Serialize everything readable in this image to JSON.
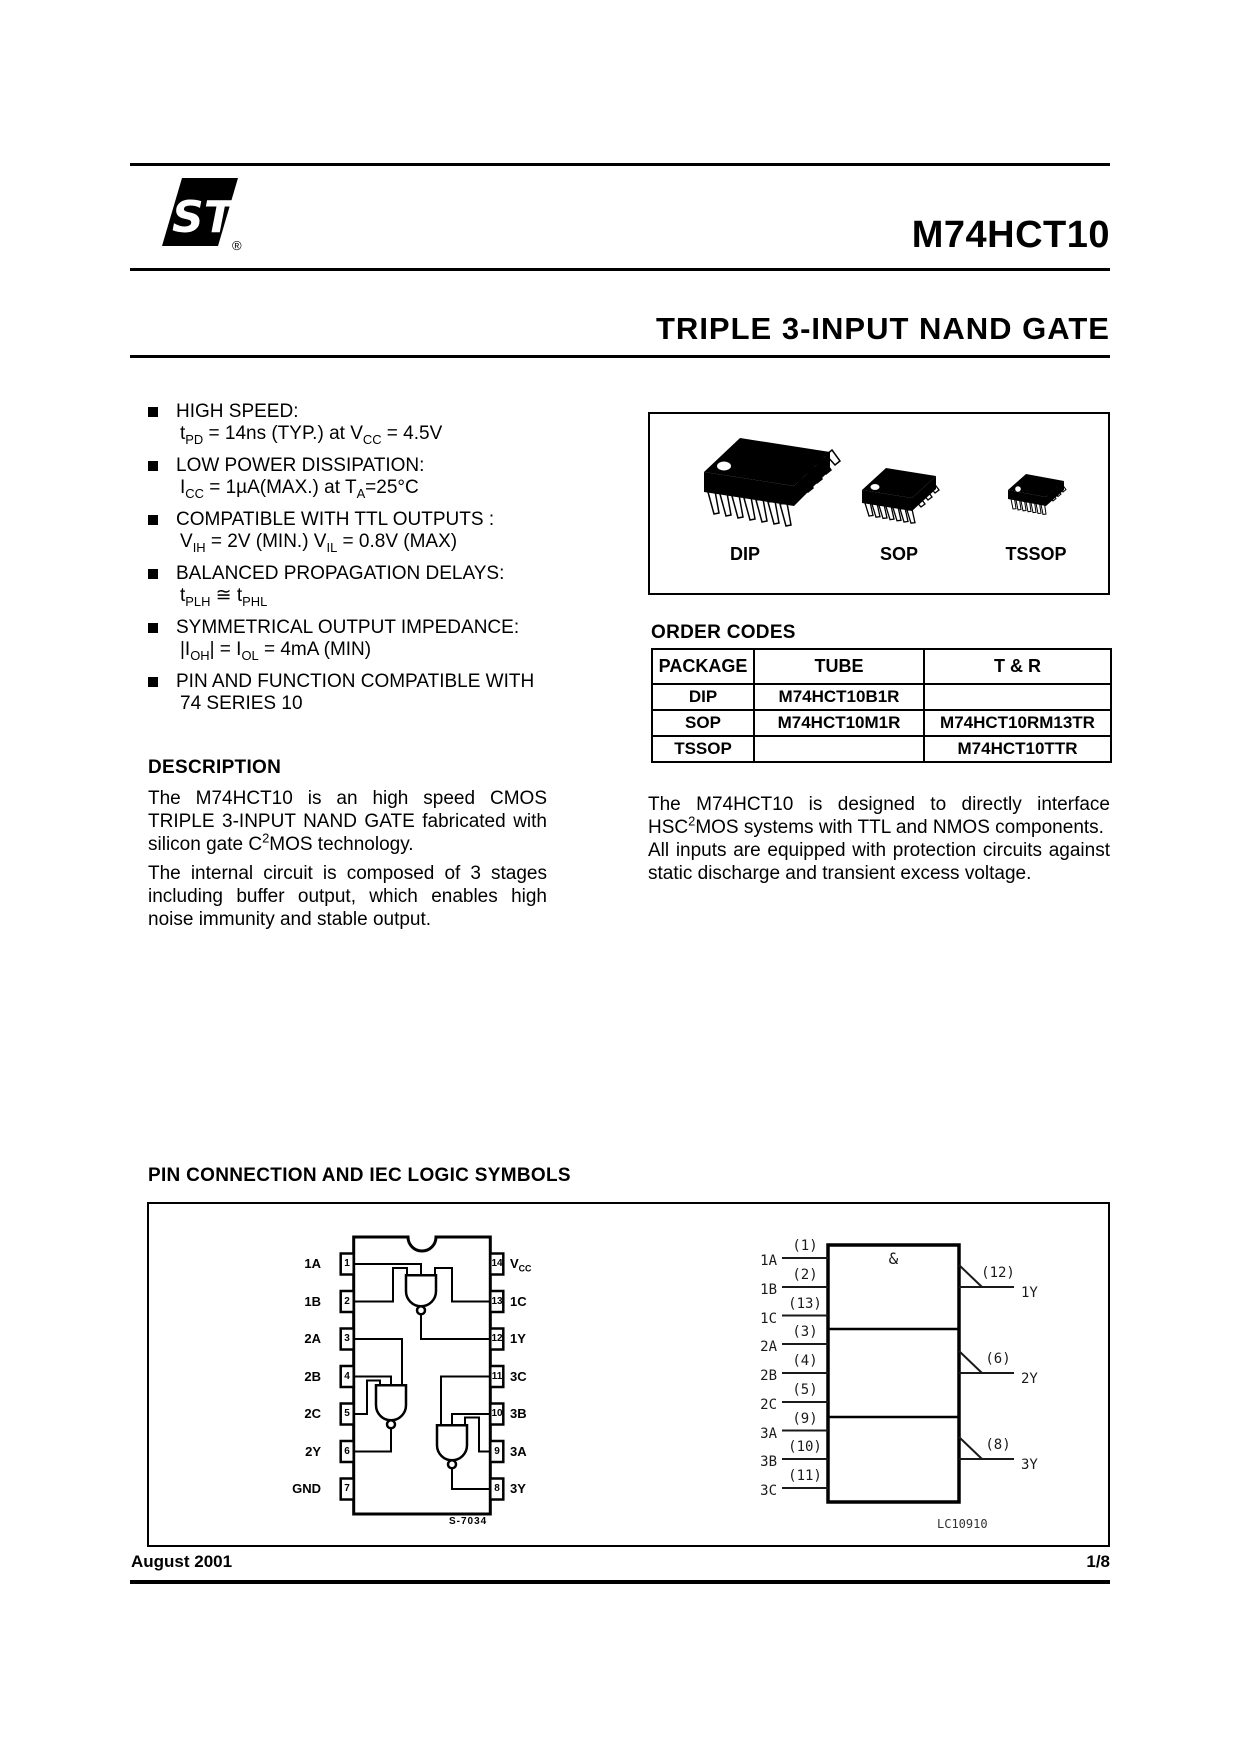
{
  "header": {
    "logo_text": "ST",
    "registered": "®",
    "part_number": "M74HCT10"
  },
  "title": "TRIPLE 3-INPUT NAND GATE",
  "features": [
    {
      "title": "HIGH SPEED:",
      "detail": "t_{PD} = 14ns (TYP.) at V_{CC} = 4.5V"
    },
    {
      "title": "LOW POWER DISSIPATION:",
      "detail": "I_{CC} = 1µA(MAX.) at T_{A}=25°C"
    },
    {
      "title": "COMPATIBLE WITH TTL OUTPUTS :",
      "detail": "V_{IH} = 2V (MIN.) V_{IL} = 0.8V (MAX)"
    },
    {
      "title": "BALANCED PROPAGATION DELAYS:",
      "detail": "t_{PLH} ≅ t_{PHL}"
    },
    {
      "title": "SYMMETRICAL OUTPUT IMPEDANCE:",
      "detail": "|I_{OH}| = I_{OL} = 4mA (MIN)"
    },
    {
      "title": "PIN AND FUNCTION COMPATIBLE WITH",
      "detail": "74 SERIES 10"
    }
  ],
  "packages": {
    "labels": [
      "DIP",
      "SOP",
      "TSSOP"
    ]
  },
  "order_codes": {
    "heading": "ORDER CODES",
    "columns": [
      "PACKAGE",
      "TUBE",
      "T & R"
    ],
    "rows": [
      [
        "DIP",
        "M74HCT10B1R",
        ""
      ],
      [
        "SOP",
        "M74HCT10M1R",
        "M74HCT10RM13TR"
      ],
      [
        "TSSOP",
        "",
        "M74HCT10TTR"
      ]
    ]
  },
  "description": {
    "heading": "DESCRIPTION",
    "paragraphs": [
      "The M74HCT10 is an high speed CMOS TRIPLE 3-INPUT NAND GATE fabricated with silicon gate C^{2}MOS technology.",
      "The internal circuit is composed of 3 stages including buffer output, which enables high noise immunity and stable output."
    ]
  },
  "interface_text": {
    "paragraphs": [
      "The M74HCT10 is designed to directly interface HSC^{2}MOS systems with TTL and NMOS components.",
      "All inputs are equipped with protection circuits against static discharge and transient excess voltage."
    ]
  },
  "figure": {
    "heading": "PIN CONNECTION AND IEC LOGIC SYMBOLS",
    "dip": {
      "left_pins": [
        {
          "name": "1A",
          "num": "1"
        },
        {
          "name": "1B",
          "num": "2"
        },
        {
          "name": "2A",
          "num": "3"
        },
        {
          "name": "2B",
          "num": "4"
        },
        {
          "name": "2C",
          "num": "5"
        },
        {
          "name": "2Y",
          "num": "6"
        },
        {
          "name": "GND",
          "num": "7"
        }
      ],
      "right_pins": [
        {
          "name": "V_{CC}",
          "num": "14"
        },
        {
          "name": "1C",
          "num": "13"
        },
        {
          "name": "1Y",
          "num": "12"
        },
        {
          "name": "3C",
          "num": "11"
        },
        {
          "name": "3B",
          "num": "10"
        },
        {
          "name": "3A",
          "num": "9"
        },
        {
          "name": "3Y",
          "num": "8"
        }
      ],
      "caption": "S-7034"
    },
    "iec": {
      "gate_label": "&",
      "inputs": [
        {
          "name": "1A",
          "pin": "(1)"
        },
        {
          "name": "1B",
          "pin": "(2)"
        },
        {
          "name": "1C",
          "pin": "(13)"
        },
        {
          "name": "2A",
          "pin": "(3)"
        },
        {
          "name": "2B",
          "pin": "(4)"
        },
        {
          "name": "2C",
          "pin": "(5)"
        },
        {
          "name": "3A",
          "pin": "(9)"
        },
        {
          "name": "3B",
          "pin": "(10)"
        },
        {
          "name": "3C",
          "pin": "(11)"
        }
      ],
      "outputs": [
        {
          "name": "1Y",
          "pin": "(12)"
        },
        {
          "name": "2Y",
          "pin": "(6)"
        },
        {
          "name": "3Y",
          "pin": "(8)"
        }
      ],
      "caption": "LC10910"
    }
  },
  "footer": {
    "date": "August 2001",
    "page": "1/8"
  }
}
